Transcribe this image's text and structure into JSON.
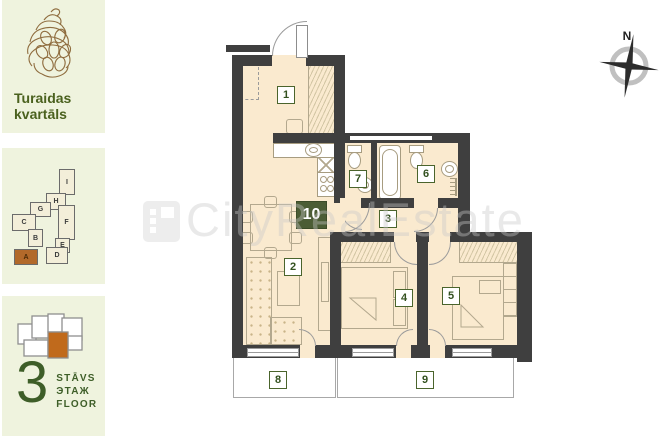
{
  "sidebar": {
    "brand": {
      "line1": "Turaidas",
      "line2": "kvartāls"
    },
    "blocks": [
      {
        "label": "I"
      },
      {
        "label": "H"
      },
      {
        "label": "G"
      },
      {
        "label": "C"
      },
      {
        "label": "B"
      },
      {
        "label": "F"
      },
      {
        "label": "E"
      },
      {
        "label": "D"
      },
      {
        "label": "A",
        "highlighted": true
      }
    ],
    "floor": {
      "number": "3",
      "lines": [
        "STĀVS",
        "ЭТАЖ",
        "FLOOR"
      ]
    }
  },
  "plan": {
    "compass_label": "N",
    "rooms": {
      "r1": "1",
      "r2": "2",
      "r3": "3",
      "r4": "4",
      "r5": "5",
      "r6": "6",
      "r7": "7",
      "r8": "8",
      "r9": "9",
      "r10": "10"
    }
  },
  "watermark": {
    "text": "CityRealEstate"
  },
  "colors": {
    "panel_bg": "#eff3de",
    "accent_green": "#4a611e",
    "highlight_orange": "#b2692a",
    "wall": "#3f3f3f",
    "floor_fill": "#faeacf",
    "label_border": "#4a642c"
  }
}
